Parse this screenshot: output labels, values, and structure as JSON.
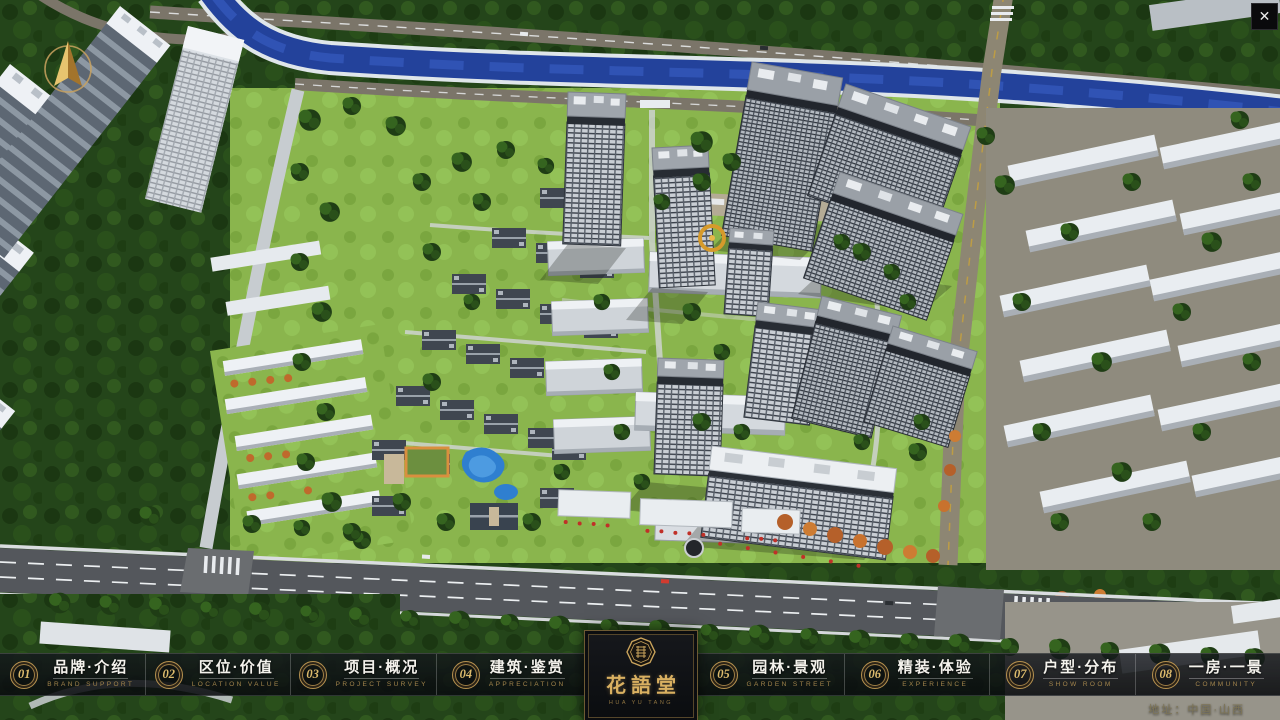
{
  "window": {
    "close_icon": "✕"
  },
  "colors": {
    "brand_gold": "#c9a25f",
    "nav_bg": "rgba(13,16,20,0.82)",
    "river_blue": "#23429b",
    "lawn_green": "#8ab54d",
    "canopy_green": "#24451a",
    "road_gray": "#55585d"
  },
  "navbar": {
    "items": [
      {
        "num": "01",
        "label": "品牌·介绍",
        "sub": "BRAND SUPPORT"
      },
      {
        "num": "02",
        "label": "区位·价值",
        "sub": "LOCATION VALUE"
      },
      {
        "num": "03",
        "label": "项目·概况",
        "sub": "PROJECT SURVEY"
      },
      {
        "num": "04",
        "label": "建筑·鉴赏",
        "sub": "APPRECIATION"
      },
      {
        "num": "05",
        "label": "园林·景观",
        "sub": "GARDEN STREET"
      },
      {
        "num": "06",
        "label": "精装·体验",
        "sub": "EXPERIENCE"
      },
      {
        "num": "07",
        "label": "户型·分布",
        "sub": "SHOW ROOM"
      },
      {
        "num": "08",
        "label": "一房·一景",
        "sub": "COMMUNITY"
      }
    ],
    "logo": {
      "title": "花語堂",
      "tagline": "HUA YU TANG"
    }
  },
  "footer": {
    "address": "地址：中国·山西"
  }
}
